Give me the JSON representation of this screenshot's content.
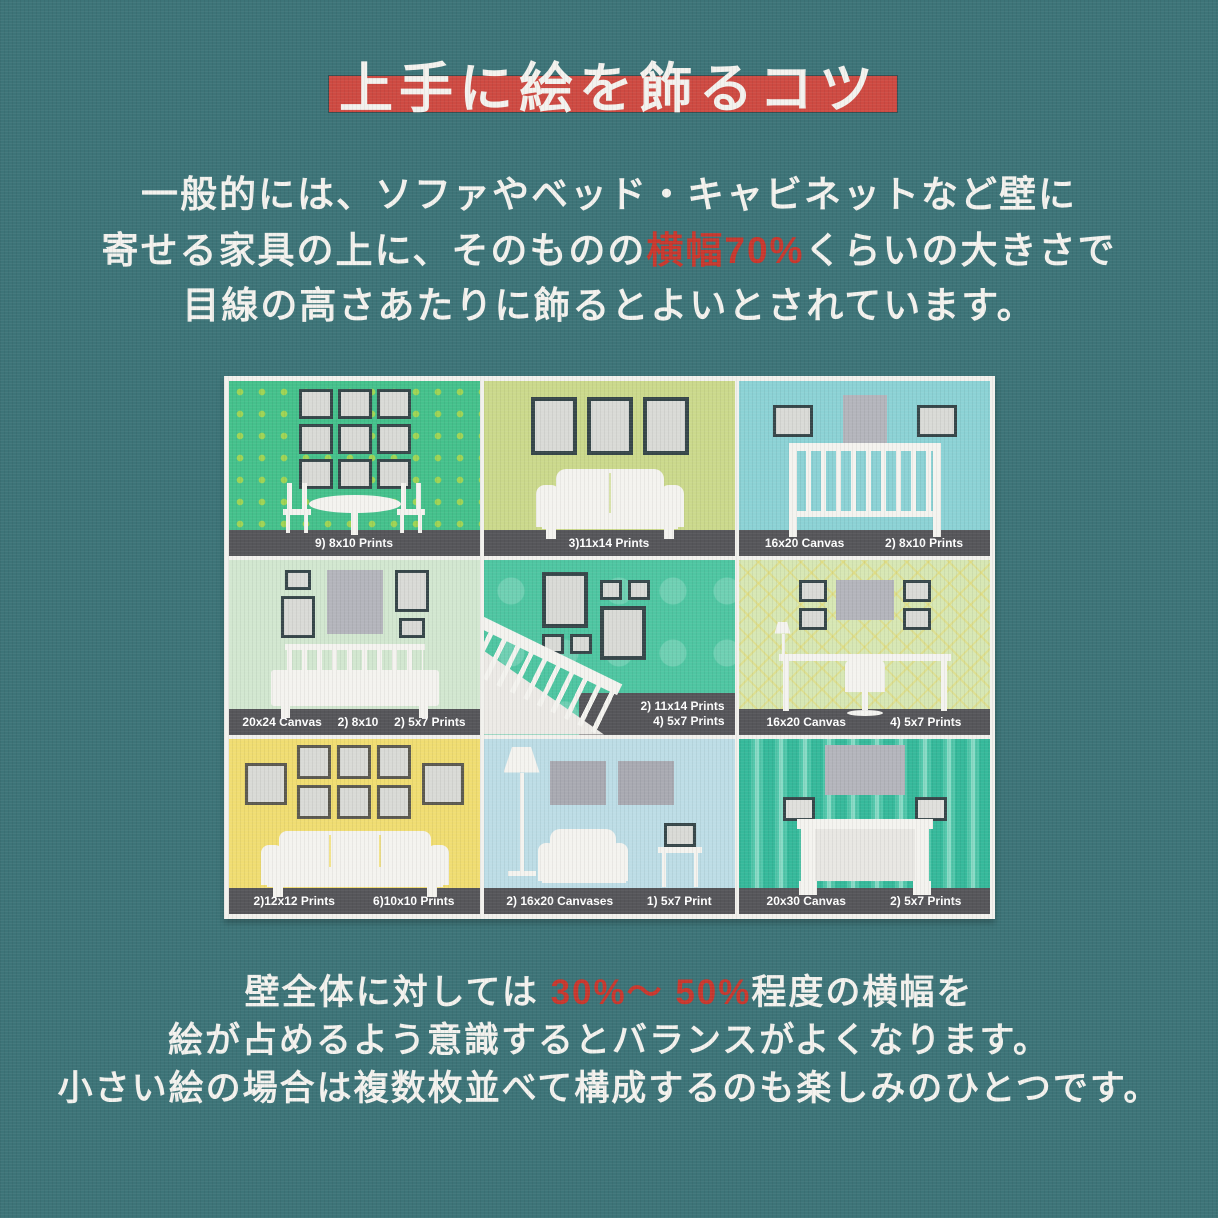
{
  "colors": {
    "background": "#3D7478",
    "title_band_red": "#CE4A42",
    "accent_text_red": "#C9382E",
    "text_white": "#F3F2EE",
    "caption_band_gray": "#56565A"
  },
  "title": {
    "text": "上手に絵を飾るコツ"
  },
  "intro": {
    "line1": "一般的には、ソファやベッド・キャビネットなど壁に",
    "line2_pre": "寄せる家具の上に、そのものの",
    "line2_red": "横幅70%",
    "line2_post": "くらいの大きさで",
    "line3": "目線の高さあたりに飾るとよいとされています。"
  },
  "grid": {
    "cells": [
      {
        "name": "dining-room",
        "labels": [
          "9) 8x10 Prints"
        ]
      },
      {
        "name": "loveseat-room",
        "labels": [
          "3)11x14 Prints"
        ]
      },
      {
        "name": "nursery",
        "labels": [
          "16x20 Canvas",
          "2) 8x10 Prints"
        ]
      },
      {
        "name": "bedroom",
        "labels": [
          "20x24 Canvas",
          "2) 8x10",
          "2) 5x7 Prints"
        ]
      },
      {
        "name": "staircase",
        "labels": [
          "2) 11x14 Prints",
          "4) 5x7 Prints"
        ]
      },
      {
        "name": "console-room",
        "labels": [
          "16x20 Canvas",
          "4) 5x7 Prints"
        ]
      },
      {
        "name": "yellow-living-room",
        "labels": [
          "2)12x12 Prints",
          "6)10x10 Prints"
        ]
      },
      {
        "name": "blue-living-room",
        "labels": [
          "2) 16x20 Canvases",
          "1) 5x7 Print"
        ]
      },
      {
        "name": "fireplace-room",
        "labels": [
          "20x30 Canvas",
          "2) 5x7 Prints"
        ]
      }
    ]
  },
  "outro": {
    "line1_pre": "壁全体に対しては ",
    "line1_red": "30%～ 50%",
    "line1_post": "程度の横幅を",
    "line2": "絵が占めるよう意識するとバランスがよくなります。",
    "line3": "小さい絵の場合は複数枚並べて構成するのも楽しみのひとつです。"
  }
}
